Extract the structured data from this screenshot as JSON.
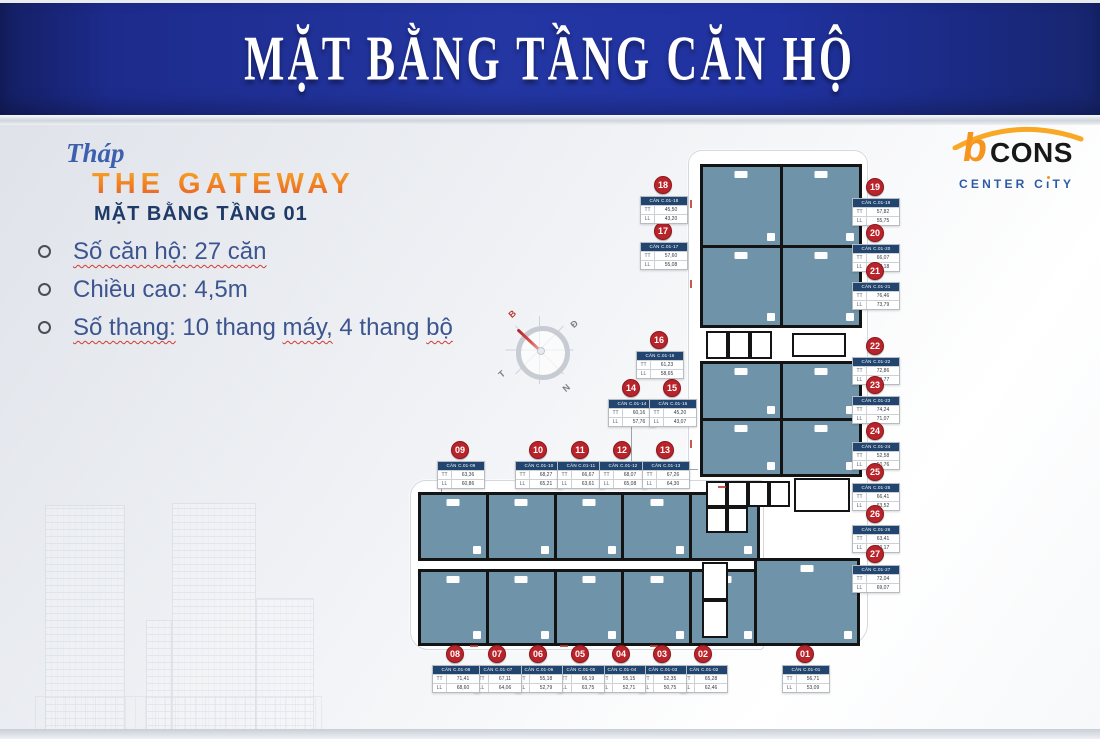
{
  "header": {
    "title": "MẶT BẰNG TẦNG CĂN HỘ"
  },
  "info": {
    "tower_script": "Tháp",
    "tower_name": "THE GATEWAY",
    "floor_title": "MẶT BẰNG TẦNG 01",
    "bullets": [
      {
        "segments": [
          {
            "text": "Số căn hộ: 27 căn",
            "wavy": true
          }
        ]
      },
      {
        "segments": [
          {
            "text": "Chiều cao: 4,5m",
            "wavy": false
          }
        ]
      },
      {
        "segments": [
          {
            "text": "Số thang:",
            "wavy": true
          },
          {
            "text": " 10 thang ",
            "wavy": false
          },
          {
            "text": "máy,",
            "wavy": true
          },
          {
            "text": " 4 thang ",
            "wavy": false
          },
          {
            "text": "bộ",
            "wavy": true
          }
        ]
      }
    ]
  },
  "logo": {
    "brand_b": "b",
    "brand_rest": "CONS",
    "subtitle_pre": "CENTER C",
    "subtitle_i": "ı",
    "subtitle_post": "TY"
  },
  "compass": {
    "north": "B",
    "east": "Đ",
    "west": "T",
    "south": "N"
  },
  "plan": {
    "row_labels": [
      "TT",
      "LL"
    ],
    "units": [
      {
        "num": "01",
        "code": "CĂN C.01-01",
        "tt": "56,71",
        "ll": "53,09"
      },
      {
        "num": "02",
        "code": "CĂN C.01-02",
        "tt": "65,28",
        "ll": "62,46"
      },
      {
        "num": "03",
        "code": "CĂN C.01-03",
        "tt": "52,35",
        "ll": "50,75"
      },
      {
        "num": "04",
        "code": "CĂN C.01-04",
        "tt": "55,15",
        "ll": "52,71"
      },
      {
        "num": "05",
        "code": "CĂN C.01-05",
        "tt": "66,19",
        "ll": "63,75"
      },
      {
        "num": "06",
        "code": "CĂN C.01-06",
        "tt": "55,18",
        "ll": "52,79"
      },
      {
        "num": "07",
        "code": "CĂN C.01-07",
        "tt": "67,11",
        "ll": "64,06"
      },
      {
        "num": "08",
        "code": "CĂN C.01-08",
        "tt": "71,41",
        "ll": "68,60"
      },
      {
        "num": "09",
        "code": "CĂN C.01-09",
        "tt": "63,36",
        "ll": "60,86"
      },
      {
        "num": "10",
        "code": "CĂN C.01-10",
        "tt": "68,27",
        "ll": "65,21"
      },
      {
        "num": "11",
        "code": "CĂN C.01-11",
        "tt": "66,67",
        "ll": "63,61"
      },
      {
        "num": "12",
        "code": "CĂN C.01-12",
        "tt": "68,07",
        "ll": "65,08"
      },
      {
        "num": "13",
        "code": "CĂN C.01-13",
        "tt": "67,26",
        "ll": "64,30"
      },
      {
        "num": "14",
        "code": "CĂN C.01-14",
        "tt": "60,16",
        "ll": "57,76"
      },
      {
        "num": "15",
        "code": "CĂN C.01-15",
        "tt": "45,20",
        "ll": "43,07"
      },
      {
        "num": "16",
        "code": "CĂN C.01-16",
        "tt": "61,23",
        "ll": "58,65"
      },
      {
        "num": "17",
        "code": "CĂN C.01-17",
        "tt": "57,60",
        "ll": "55,08"
      },
      {
        "num": "18",
        "code": "CĂN C.01-18",
        "tt": "45,50",
        "ll": "43,20"
      },
      {
        "num": "19",
        "code": "CĂN C.01-19",
        "tt": "57,82",
        "ll": "55,75"
      },
      {
        "num": "20",
        "code": "CĂN C.01-20",
        "tt": "66,07",
        "ll": "63,18"
      },
      {
        "num": "21",
        "code": "CĂN C.01-21",
        "tt": "76,46",
        "ll": "73,79"
      },
      {
        "num": "22",
        "code": "CĂN C.01-22",
        "tt": "72,86",
        "ll": "69,77"
      },
      {
        "num": "23",
        "code": "CĂN C.01-23",
        "tt": "74,24",
        "ll": "71,07"
      },
      {
        "num": "24",
        "code": "CĂN C.01-24",
        "tt": "52,58",
        "ll": "50,76"
      },
      {
        "num": "25",
        "code": "CĂN C.01-25",
        "tt": "66,41",
        "ll": "63,52"
      },
      {
        "num": "26",
        "code": "CĂN C.01-26",
        "tt": "63,41",
        "ll": "60,17"
      },
      {
        "num": "27",
        "code": "CĂN C.01-27",
        "tt": "72,04",
        "ll": "69,07"
      }
    ]
  },
  "colors": {
    "banner_blue": "#2033a0",
    "accent_orange": "#f7941d",
    "badge_red": "#b9242b",
    "room_fill": "#6f93a8",
    "table_header": "#21456e",
    "text_blue": "#3c558e"
  }
}
